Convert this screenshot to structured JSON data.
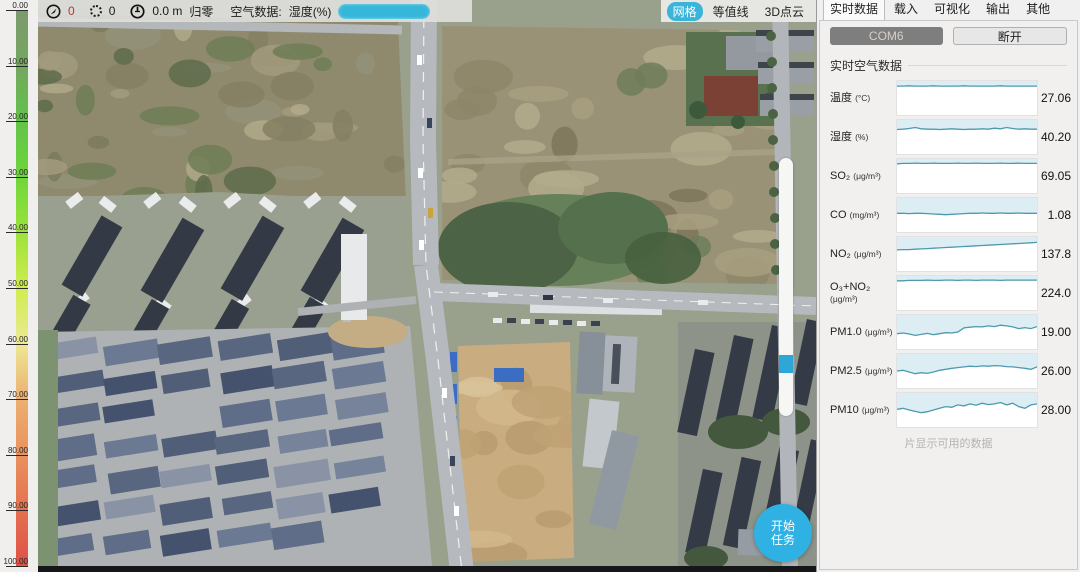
{
  "toolbar": {
    "compass_value": "0",
    "points_value": "0",
    "altitude_value": "0.0 m",
    "zero_button": "归零",
    "air_data_label": "空气数据:",
    "air_data_field": "湿度(%)",
    "selected_option": ""
  },
  "map_tabs": [
    {
      "label": "网格",
      "active": true
    },
    {
      "label": "等值线",
      "active": false
    },
    {
      "label": "3D点云",
      "active": false
    }
  ],
  "start_task": {
    "line1": "开始",
    "line2": "任务"
  },
  "colorbar": {
    "ticks": [
      "0.00",
      "10.00",
      "20.00",
      "30.00",
      "40.00",
      "50.00",
      "60.00",
      "70.00",
      "80.00",
      "90.00",
      "100.00"
    ]
  },
  "panel": {
    "tabs": [
      {
        "label": "实时数据",
        "active": true
      },
      {
        "label": "载入",
        "active": false
      },
      {
        "label": "可视化",
        "active": false
      },
      {
        "label": "输出",
        "active": false
      },
      {
        "label": "其他",
        "active": false
      }
    ],
    "com_button": "COM6",
    "disconnect_button": "断开",
    "group_title": "实时空气数据",
    "footer_note": "片显示可用的数据",
    "rows": [
      {
        "name": "温度",
        "unit": "(°C)",
        "value": "27.06",
        "spark": [
          0.85,
          0.85,
          0.86,
          0.85,
          0.85,
          0.85,
          0.86,
          0.85,
          0.85,
          0.85,
          0.85,
          0.86,
          0.85,
          0.85,
          0.85,
          0.85,
          0.85,
          0.86,
          0.85,
          0.85,
          0.85,
          0.85,
          0.85,
          0.85
        ]
      },
      {
        "name": "湿度",
        "unit": "(%)",
        "value": "40.20",
        "spark": [
          0.72,
          0.73,
          0.75,
          0.78,
          0.74,
          0.73,
          0.73,
          0.72,
          0.73,
          0.74,
          0.73,
          0.72,
          0.73,
          0.73,
          0.74,
          0.73,
          0.76,
          0.74,
          0.78,
          0.75,
          0.73,
          0.74,
          0.73,
          0.73
        ]
      },
      {
        "name": "SO₂",
        "unit": "(μg/m³)",
        "value": "69.05",
        "spark": [
          0.86,
          0.87,
          0.87,
          0.88,
          0.87,
          0.87,
          0.88,
          0.87,
          0.87,
          0.87,
          0.88,
          0.87,
          0.87,
          0.88,
          0.87,
          0.87,
          0.87,
          0.88,
          0.87,
          0.87,
          0.88,
          0.87,
          0.87,
          0.87
        ]
      },
      {
        "name": "CO",
        "unit": "(mg/m³)",
        "value": "1.08",
        "spark": [
          0.55,
          0.55,
          0.54,
          0.55,
          0.55,
          0.54,
          0.53,
          0.52,
          0.51,
          0.52,
          0.53,
          0.54,
          0.55,
          0.55,
          0.56,
          0.55,
          0.55,
          0.56,
          0.55,
          0.55,
          0.56,
          0.55,
          0.55,
          0.55
        ]
      },
      {
        "name": "NO₂",
        "unit": "(μg/m³)",
        "value": "137.8",
        "spark": [
          0.62,
          0.63,
          0.63,
          0.64,
          0.65,
          0.66,
          0.67,
          0.68,
          0.69,
          0.7,
          0.71,
          0.72,
          0.73,
          0.74,
          0.75,
          0.76,
          0.77,
          0.78,
          0.79,
          0.8,
          0.81,
          0.82,
          0.83,
          0.84
        ]
      },
      {
        "name": "O₃+NO₂",
        "unit": "(μg/m³)",
        "value": "224.0",
        "spark": [
          0.86,
          0.86,
          0.87,
          0.87,
          0.87,
          0.88,
          0.87,
          0.87,
          0.88,
          0.88,
          0.87,
          0.88,
          0.88,
          0.87,
          0.88,
          0.88,
          0.88,
          0.87,
          0.88,
          0.88,
          0.88,
          0.88,
          0.88,
          0.88
        ]
      },
      {
        "name": "PM1.0",
        "unit": "(μg/m³)",
        "value": "19.00",
        "spark": [
          0.45,
          0.47,
          0.44,
          0.4,
          0.43,
          0.46,
          0.42,
          0.45,
          0.48,
          0.47,
          0.5,
          0.62,
          0.64,
          0.66,
          0.65,
          0.68,
          0.66,
          0.7,
          0.68,
          0.65,
          0.6,
          0.63,
          0.6,
          0.66
        ]
      },
      {
        "name": "PM2.5",
        "unit": "(μg/m³)",
        "value": "26.00",
        "spark": [
          0.5,
          0.52,
          0.47,
          0.42,
          0.45,
          0.43,
          0.47,
          0.52,
          0.55,
          0.58,
          0.6,
          0.62,
          0.64,
          0.63,
          0.65,
          0.64,
          0.66,
          0.65,
          0.63,
          0.62,
          0.6,
          0.58,
          0.55,
          0.62
        ]
      },
      {
        "name": "PM10",
        "unit": "(μg/m³)",
        "value": "28.00",
        "spark": [
          0.52,
          0.55,
          0.5,
          0.46,
          0.42,
          0.45,
          0.5,
          0.55,
          0.6,
          0.58,
          0.65,
          0.62,
          0.68,
          0.64,
          0.7,
          0.66,
          0.68,
          0.72,
          0.65,
          0.7,
          0.6,
          0.55,
          0.65,
          0.68
        ]
      }
    ]
  },
  "colors": {
    "accent_cyan": "#35b7da",
    "spark_line": "#4d9aad",
    "spark_fill": "#dcedf4",
    "value_red": "#b03a2e"
  }
}
